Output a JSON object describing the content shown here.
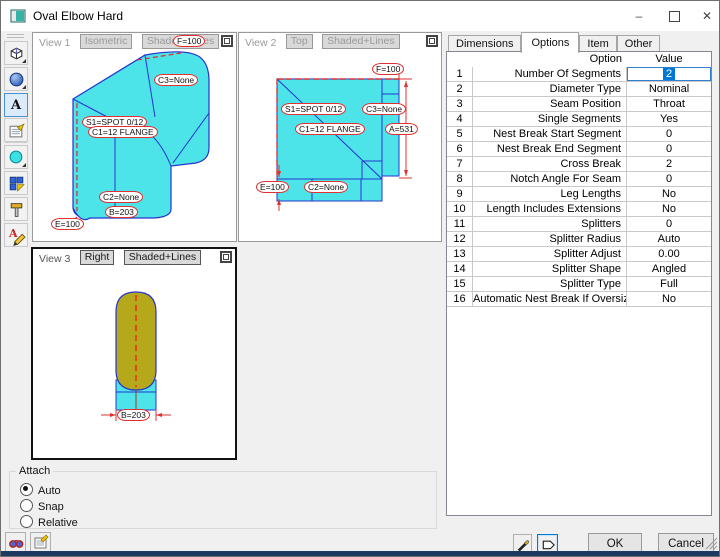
{
  "window": {
    "title": "Oval Elbow Hard",
    "controls": {
      "minimize": "–",
      "close": "✕"
    }
  },
  "toolbar": {
    "icons": [
      "cube-view",
      "sphere-shading",
      "annotations",
      "properties-form",
      "ellipse-shape",
      "pattern-grid",
      "tools-hammer",
      "markup-pen"
    ]
  },
  "views": {
    "v1": {
      "title": "View 1",
      "proj": "Isometric",
      "shade": "Shaded+Lines",
      "labels": {
        "f": "F=100",
        "c3": "C3=None",
        "s1": "S1=SPOT 0/12",
        "c1": "C1=12 FLANGE",
        "c2": "C2=None",
        "b": "B=203",
        "e": "E=100"
      }
    },
    "v2": {
      "title": "View 2",
      "proj": "Top",
      "shade": "Shaded+Lines",
      "labels": {
        "f": "F=100",
        "s1": "S1=SPOT 0/12",
        "c3": "C3=None",
        "c1": "C1=12 FLANGE",
        "a": "A=531",
        "e": "E=100",
        "c2": "C2=None"
      }
    },
    "v3": {
      "title": "View 3",
      "proj": "Right",
      "shade": "Shaded+Lines",
      "labels": {
        "b": "B=203"
      }
    }
  },
  "tabs": {
    "items": [
      "Dimensions",
      "Options",
      "Item",
      "Other"
    ],
    "active": "Options"
  },
  "grid": {
    "columns": [
      "Option",
      "Value"
    ],
    "selected_row": 1,
    "rows": [
      {
        "num": "1",
        "option": "Number Of Segments",
        "value": "2"
      },
      {
        "num": "2",
        "option": "Diameter Type",
        "value": "Nominal"
      },
      {
        "num": "3",
        "option": "Seam Position",
        "value": "Throat"
      },
      {
        "num": "4",
        "option": "Single Segments",
        "value": "Yes"
      },
      {
        "num": "5",
        "option": "Nest Break Start Segment",
        "value": "0"
      },
      {
        "num": "6",
        "option": "Nest Break End Segment",
        "value": "0"
      },
      {
        "num": "7",
        "option": "Cross Break",
        "value": "2"
      },
      {
        "num": "8",
        "option": "Notch Angle For Seam",
        "value": "0"
      },
      {
        "num": "9",
        "option": "Leg Lengths",
        "value": "No"
      },
      {
        "num": "10",
        "option": "Length Includes Extensions",
        "value": "No"
      },
      {
        "num": "11",
        "option": "Splitters",
        "value": "0"
      },
      {
        "num": "12",
        "option": "Splitter Radius",
        "value": "Auto"
      },
      {
        "num": "13",
        "option": "Splitter Adjust",
        "value": "0.00"
      },
      {
        "num": "14",
        "option": "Splitter Shape",
        "value": "Angled"
      },
      {
        "num": "15",
        "option": "Splitter Type",
        "value": "Full"
      },
      {
        "num": "16",
        "option": "Automatic Nest Break If Oversize",
        "value": "No"
      }
    ]
  },
  "attach": {
    "title": "Attach",
    "options": [
      "Auto",
      "Snap",
      "Relative"
    ],
    "selected": "Auto"
  },
  "footer": {
    "ok": "OK",
    "cancel": "Cancel"
  },
  "colors": {
    "shape_cyan": "#4de4e9",
    "shape_olive": "#b5a81b",
    "edge_blue": "#2633cf",
    "dim_red": "#e03030",
    "selection_blue": "#0078d7"
  }
}
